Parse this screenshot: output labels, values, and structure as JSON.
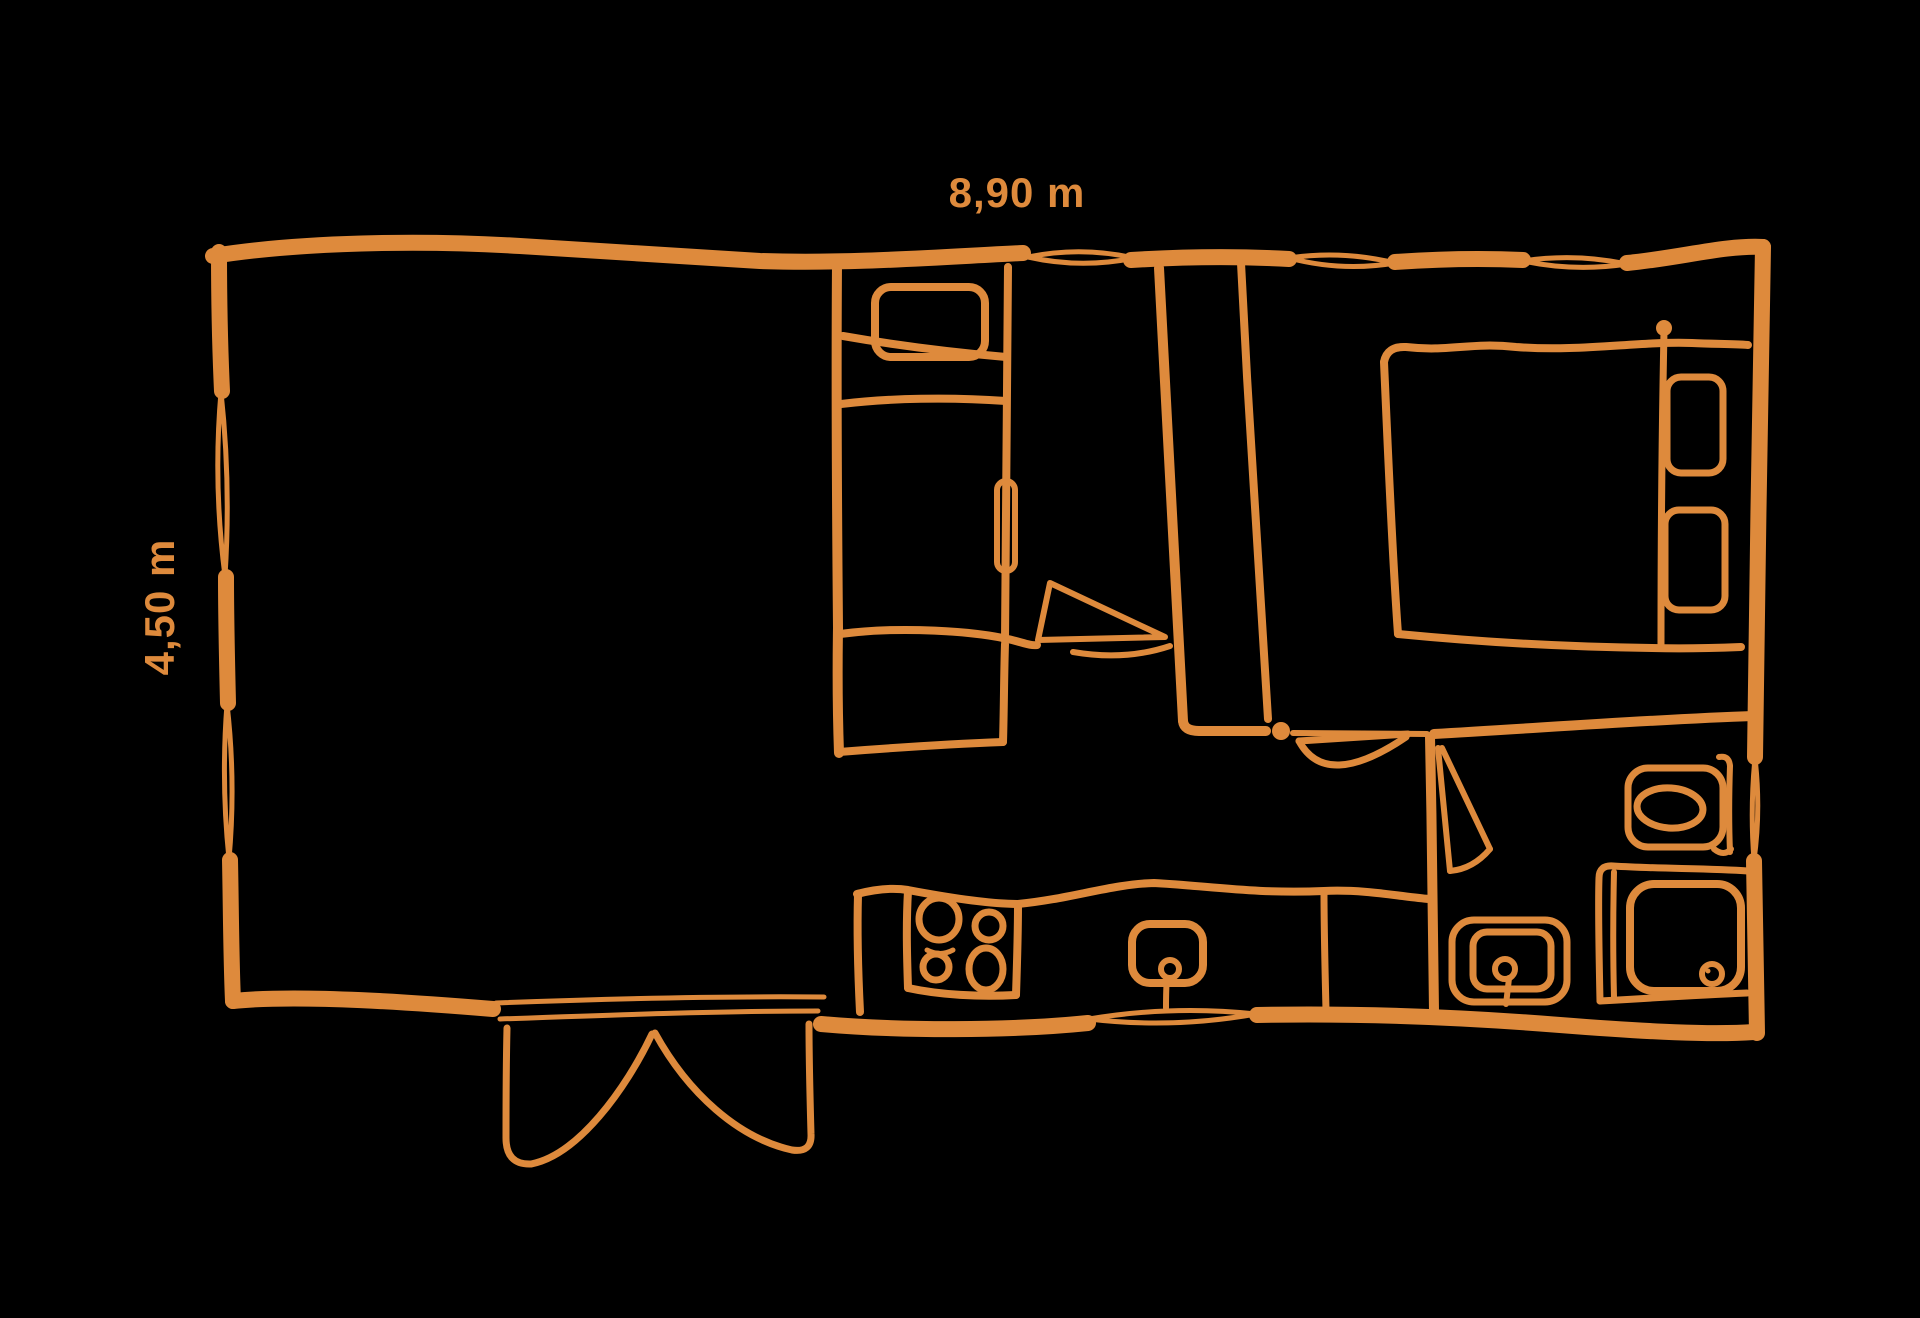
{
  "canvas": {
    "background_color": "#000000",
    "accent_color": "#DE8A3C"
  },
  "floor_plan": {
    "type": "mobile-home floor plan sketch",
    "dimension_width_label": "8,90 m",
    "dimension_height_label": "4,50 m",
    "element_names": [
      "outer-walls",
      "windows",
      "entrance-double-door",
      "kitchen-counter",
      "hob-four-burners",
      "kitchen-sink",
      "single-bedroom",
      "single-bed",
      "foot-cabinet",
      "sliding-door-handle",
      "wardrobe-partition",
      "corridor-door",
      "double-bedroom",
      "double-bed",
      "bed-pillows",
      "bathroom",
      "bathroom-door",
      "toilet",
      "shower",
      "washbasin"
    ]
  }
}
